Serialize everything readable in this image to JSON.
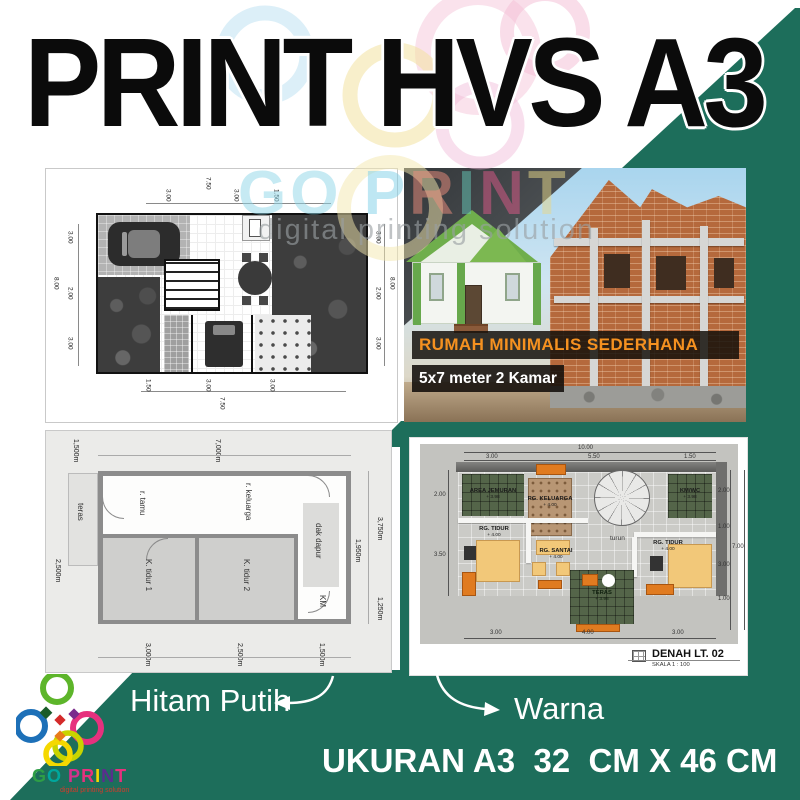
{
  "title": "PRINT HVS A3",
  "size_label": "UKURAN A3  32  CM X 46 CM",
  "annotations": {
    "bw": "Hitam Putih",
    "warna": "Warna"
  },
  "watermark": {
    "letters": [
      "G",
      "O",
      "P",
      "R",
      "I",
      "N",
      "T"
    ],
    "tagline": "digital printing solution"
  },
  "logo": {
    "letters": [
      "G",
      "O",
      "P",
      "R",
      "I",
      "N",
      "T"
    ],
    "tagline": "digital printing solution"
  },
  "colors": {
    "green": "#1d6e5b",
    "headline_orange": "#f59120",
    "brick": "#b5693c",
    "tile_green": "#546549",
    "furniture_orange": "#e07b20",
    "bed_yellow": "#f2c879",
    "logo_red": "#d43a2a"
  },
  "bw_plan1": {
    "top_outer": "7.50",
    "top": [
      "3.00",
      "3.00",
      "1.50"
    ],
    "left_outer": "8.00",
    "left": [
      "3.00",
      "2.00",
      "3.00"
    ],
    "right_outer": "8.00",
    "right": [
      "3.00",
      "2.00",
      "3.00"
    ],
    "bottom_outer": "7.50",
    "bottom": [
      "1.50",
      "3.00",
      "3.00"
    ]
  },
  "house_panel": {
    "headline": "RUMAH MINIMALIS SEDERHANA",
    "subline": "5x7 meter 2 Kamar"
  },
  "bw_plan2": {
    "rooms": {
      "teras": "teras",
      "tamu": "r. tamu",
      "keluarga": "r. keluarga",
      "tidur1": "K. tidur 1",
      "tidur2": "K. tidur 2",
      "dapur": "dak dapur",
      "km": "KM"
    },
    "dims": {
      "top_left": "1,500m",
      "top": "7,000m",
      "left": "2,500m",
      "right_outer": "3,750m",
      "right_inner": "1,950m",
      "right_lower": "1,250m",
      "bottom": [
        "3,000m",
        "2,500m",
        "1,500m"
      ]
    }
  },
  "color_plan": {
    "rooms": {
      "jemuran": {
        "name": "AREA JEMURAN",
        "elev": "+ 3.98"
      },
      "keluarga": {
        "name": "RG. KELUARGA",
        "elev": "+ 4.00"
      },
      "kmwc": {
        "name": "KM/WC",
        "elev": "+ 3.98"
      },
      "tidur_kiri": {
        "name": "RG. TIDUR",
        "elev": "+ 4.00"
      },
      "santai": {
        "name": "RG. SANTAI",
        "elev": "+ 4.00"
      },
      "tidur_kanan": {
        "name": "RG. TIDUR",
        "elev": "+ 4.00"
      },
      "teras": {
        "name": "TERAS",
        "elev": "+ 3.98"
      }
    },
    "stair_label": "turun",
    "dims": {
      "top_outer": "10.00",
      "top": [
        "3.00",
        "5.50",
        "1.50"
      ],
      "left": [
        "2.00",
        "3.50"
      ],
      "right": [
        "2.00",
        "1.00",
        "3.00",
        "1.00"
      ],
      "right_outer": "7.00",
      "bottom": [
        "3.00",
        "4.00",
        "3.00"
      ]
    },
    "footer_title": "DENAH LT. 02",
    "footer_scale": "SKALA 1 : 100"
  }
}
